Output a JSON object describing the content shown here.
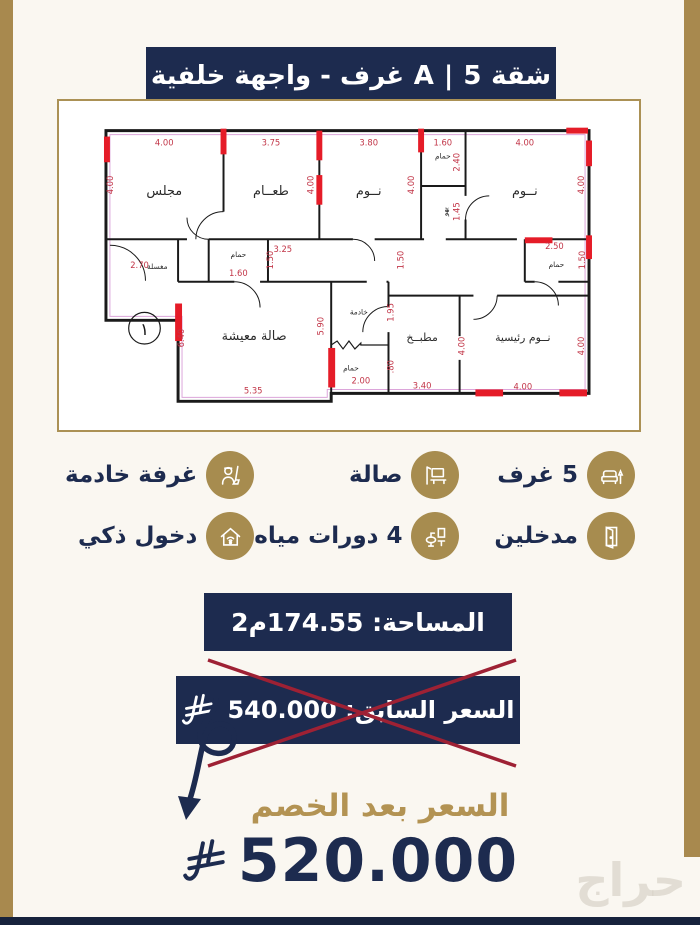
{
  "colors": {
    "navy": "#1d2b4f",
    "gold": "#a8894e",
    "gold_text": "#b39353",
    "column_red": "#e51c28",
    "dim_red": "#c23648",
    "x_red": "#9e2134",
    "background": "#faf7f1"
  },
  "header": {
    "title": "شقة A | 5 غرف - واجهة خلفية"
  },
  "floorplan": {
    "plan_number": "١",
    "rooms": {
      "majlis": "مجلس",
      "dining": "طعــام",
      "bedroom": "نــوم",
      "bath": "حمام",
      "lobby": "بهو",
      "wash": "مغسلة",
      "living": "صالة معيشة",
      "maid": "خادمة",
      "kitchen": "مطبــخ",
      "master": "نــوم رئيسية"
    },
    "dims": {
      "d4": "4.00",
      "d375": "3.75",
      "d38": "3.80",
      "d16": "1.60",
      "d24": "2.40",
      "d145": "1.45",
      "d325": "3.25",
      "d15": "1.50",
      "d27": "2.70",
      "d25": "2.50",
      "d64": "6.40",
      "d59": "5.90",
      "d535": "5.35",
      "d195": "1.95",
      "d2": "2.00",
      "d08": ".80",
      "d34": "3.40"
    }
  },
  "features": {
    "items": [
      {
        "label": "5 غرف",
        "icon": "sofa-icon"
      },
      {
        "label": "صالة",
        "icon": "tv-console-icon"
      },
      {
        "label": "غرفة خادمة",
        "icon": "maid-icon"
      },
      {
        "label": "مدخلين",
        "icon": "door-icon"
      },
      {
        "label": "4 دورات مياه",
        "icon": "bathroom-icon"
      },
      {
        "label": "دخول ذكي",
        "icon": "smart-home-icon"
      }
    ]
  },
  "area": {
    "label": "المساحة: 174.55م2"
  },
  "pricing": {
    "previous_label": "السعر السابق: 540.000",
    "discount_label": "السعر بعد الخصم",
    "discounted_price": "520.000",
    "currency_icon": "saudi-riyal-symbol"
  },
  "watermark": "حراج"
}
